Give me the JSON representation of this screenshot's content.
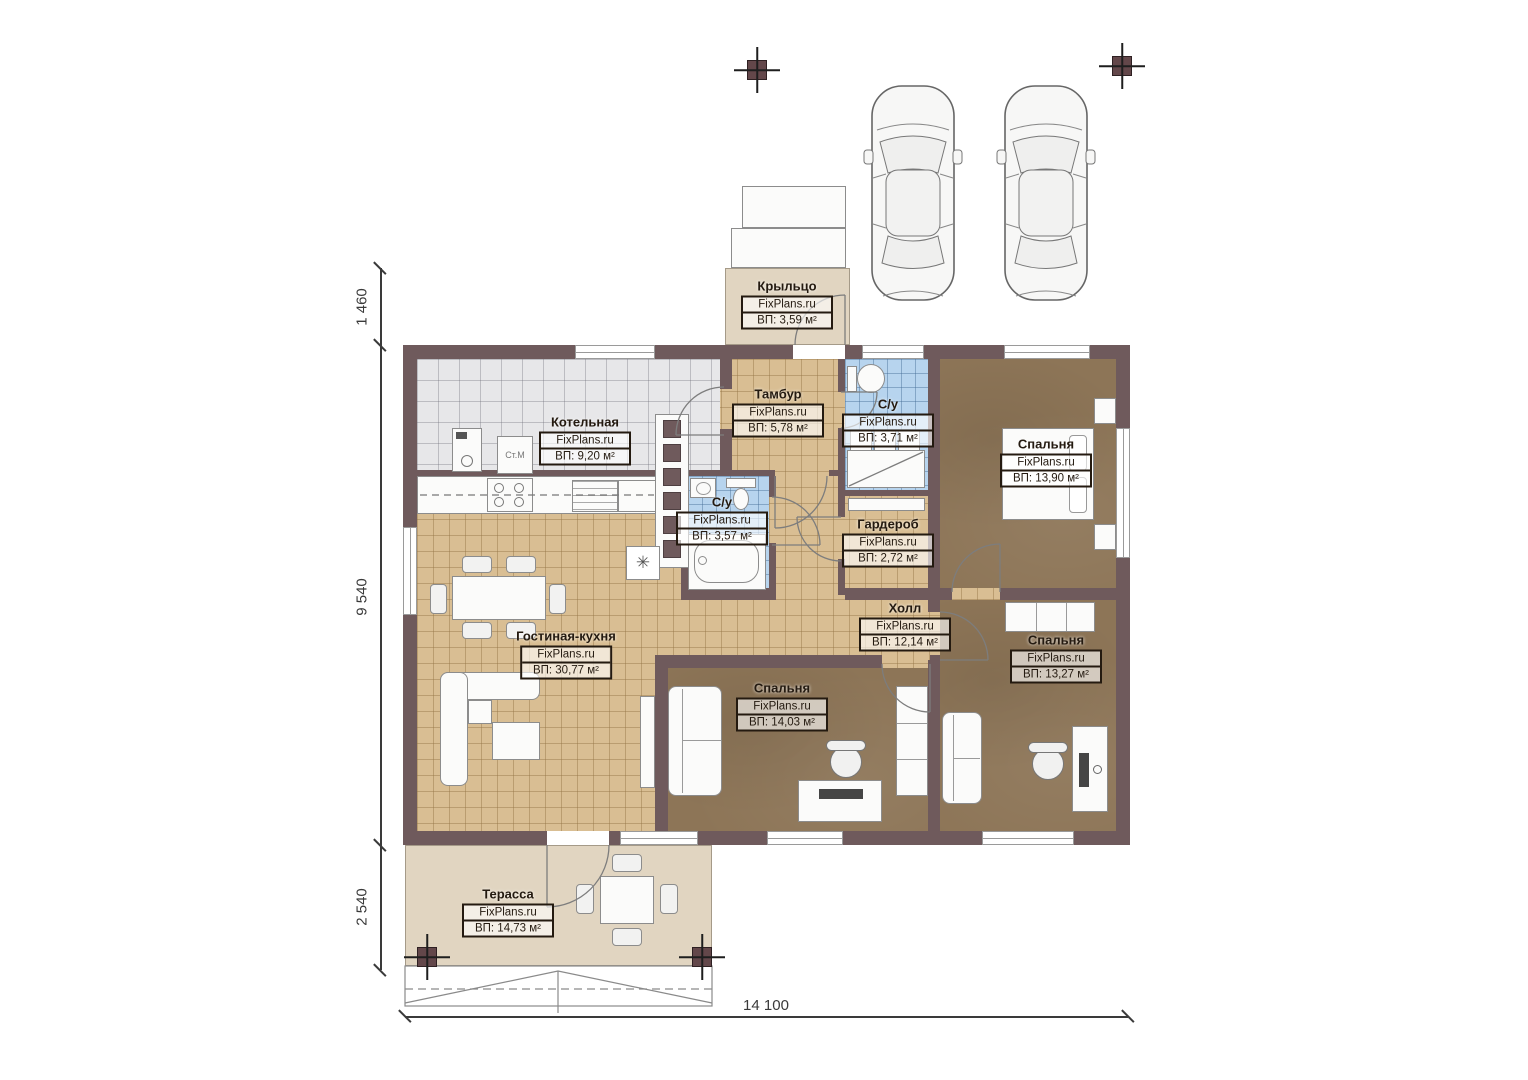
{
  "rooms": [
    {
      "key": "porch",
      "name": "Крыльцо",
      "site": "FixPlans.ru",
      "area": "ВП: 3,59 м²"
    },
    {
      "key": "boiler-room",
      "name": "Котельная",
      "site": "FixPlans.ru",
      "area": "ВП: 9,20 м²"
    },
    {
      "key": "vestibule",
      "name": "Тамбур",
      "site": "FixPlans.ru",
      "area": "ВП: 5,78 м²"
    },
    {
      "key": "bathroom-top",
      "name": "С/у",
      "site": "FixPlans.ru",
      "area": "ВП: 3,71 м²"
    },
    {
      "key": "bedroom-top-right",
      "name": "Спальня",
      "site": "FixPlans.ru",
      "area": "ВП: 13,90 м²"
    },
    {
      "key": "bathroom-mid",
      "name": "С/у",
      "site": "FixPlans.ru",
      "area": "ВП: 3,57 м²"
    },
    {
      "key": "wardrobe",
      "name": "Гардероб",
      "site": "FixPlans.ru",
      "area": "ВП: 2,72 м²"
    },
    {
      "key": "hall",
      "name": "Холл",
      "site": "FixPlans.ru",
      "area": "ВП: 12,14 м²"
    },
    {
      "key": "living-kitchen",
      "name": "Гостиная-кухня",
      "site": "FixPlans.ru",
      "area": "ВП: 30,77 м²"
    },
    {
      "key": "bedroom-bottom-mid",
      "name": "Спальня",
      "site": "FixPlans.ru",
      "area": "ВП: 14,03 м²"
    },
    {
      "key": "bedroom-bottom-right",
      "name": "Спальня",
      "site": "FixPlans.ru",
      "area": "ВП: 13,27 м²"
    },
    {
      "key": "terrace",
      "name": "Терасса",
      "site": "FixPlans.ru",
      "area": "ВП: 14,73 м²"
    }
  ],
  "dimensions": {
    "left_top": "1 460",
    "left_mid": "9 540",
    "left_bottom": "2 540",
    "bottom": "14 100"
  },
  "equipment": {
    "washing_machine": "Ст.М",
    "vent_symbol": "✳"
  }
}
